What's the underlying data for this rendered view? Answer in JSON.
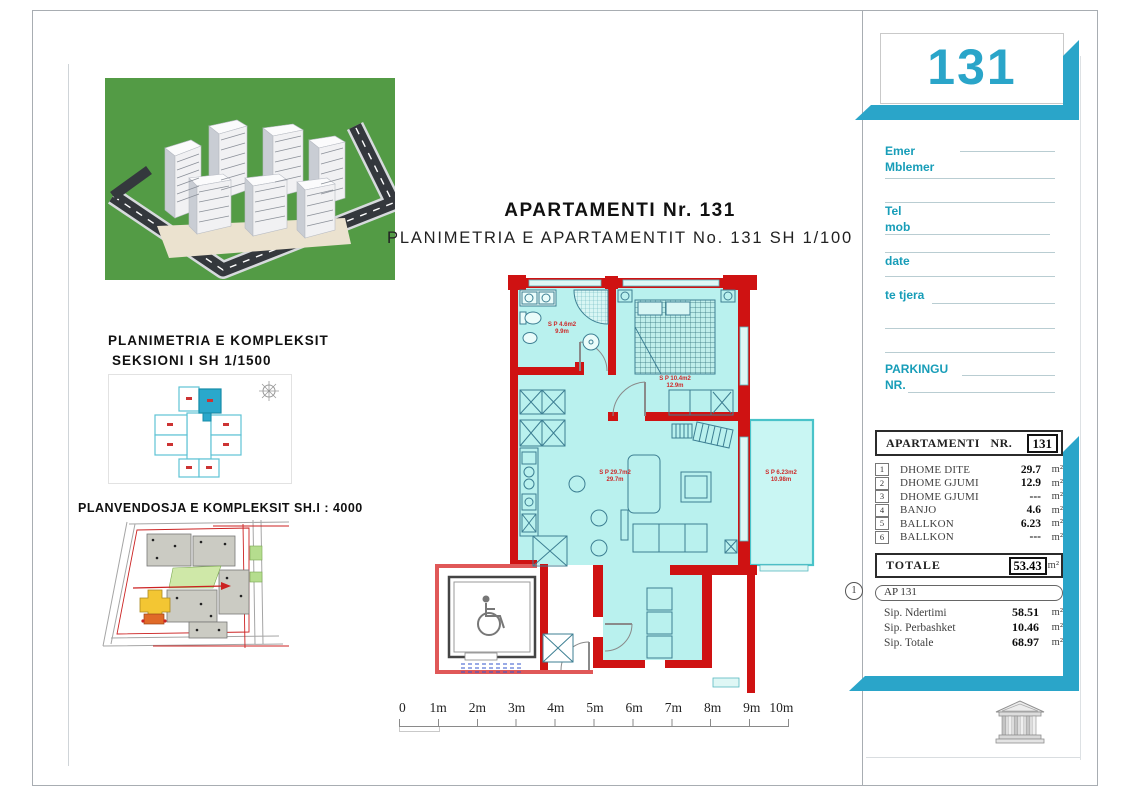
{
  "sheet_number": "131",
  "header": {
    "title": "APARTAMENTI Nr. 131",
    "subtitle": "PLANIMETRIA E APARTAMENTIT No. 131 SH 1/100"
  },
  "left": {
    "section_title_line1": "PLANIMETRIA E KOMPLEKSIT",
    "section_title_line2": "SEKSIONI I   SH 1/1500",
    "siteplan_title": "PLANVENDOSJA E KOMPLEKSIT SH.I : 4000"
  },
  "form": {
    "emer": "Emer",
    "mblemer": "Mblemer",
    "tel": "Tel",
    "mob": "mob",
    "date": "date",
    "te_tjera": "te tjera",
    "parkingu": "PARKINGU",
    "nr": "NR."
  },
  "table": {
    "header": "APARTAMENTI NR.",
    "header_number": "131",
    "rows": [
      {
        "num": "1",
        "name": "DHOME DITE",
        "value": "29.7",
        "unit": "m²"
      },
      {
        "num": "2",
        "name": "DHOME GJUMI",
        "value": "12.9",
        "unit": "m²"
      },
      {
        "num": "3",
        "name": "DHOME GJUMI",
        "value": "---",
        "unit": "m²"
      },
      {
        "num": "4",
        "name": "BANJO",
        "value": "4.6",
        "unit": "m²"
      },
      {
        "num": "5",
        "name": "BALLKON",
        "value": "6.23",
        "unit": "m²"
      },
      {
        "num": "6",
        "name": "BALLKON",
        "value": "---",
        "unit": "m²"
      }
    ],
    "totale_label": "TOTALE",
    "totale_value": "53.43",
    "totale_unit": "m²",
    "ap_circle": "1",
    "ap_label": "AP 131",
    "ap_rows": [
      {
        "name": "Sip. Ndertimi",
        "value": "58.51",
        "unit": "m²"
      },
      {
        "name": "Sip. Perbashket",
        "value": "10.46",
        "unit": "m²"
      },
      {
        "name": "Sip. Totale",
        "value": "68.97",
        "unit": "m²"
      }
    ]
  },
  "plan": {
    "labels": [
      {
        "line1": "S P 4.6m2",
        "line2": "9.9m"
      },
      {
        "line1": "S P 10.4m2",
        "line2": "12.9m"
      },
      {
        "line1": "S P 29.7m2",
        "line2": "29.7m"
      },
      {
        "line1": "S P 6.23m2",
        "line2": "10.98m"
      }
    ]
  },
  "ruler": {
    "ticks": [
      "0",
      "1m",
      "2m",
      "3m",
      "4m",
      "5m",
      "6m",
      "7m",
      "8m",
      "9m",
      "10m"
    ]
  },
  "colors": {
    "accent": "#2aa5c9",
    "wall_red": "#cf1212",
    "plan_fill": "#b9f1ee",
    "label_teal": "#179db8"
  }
}
